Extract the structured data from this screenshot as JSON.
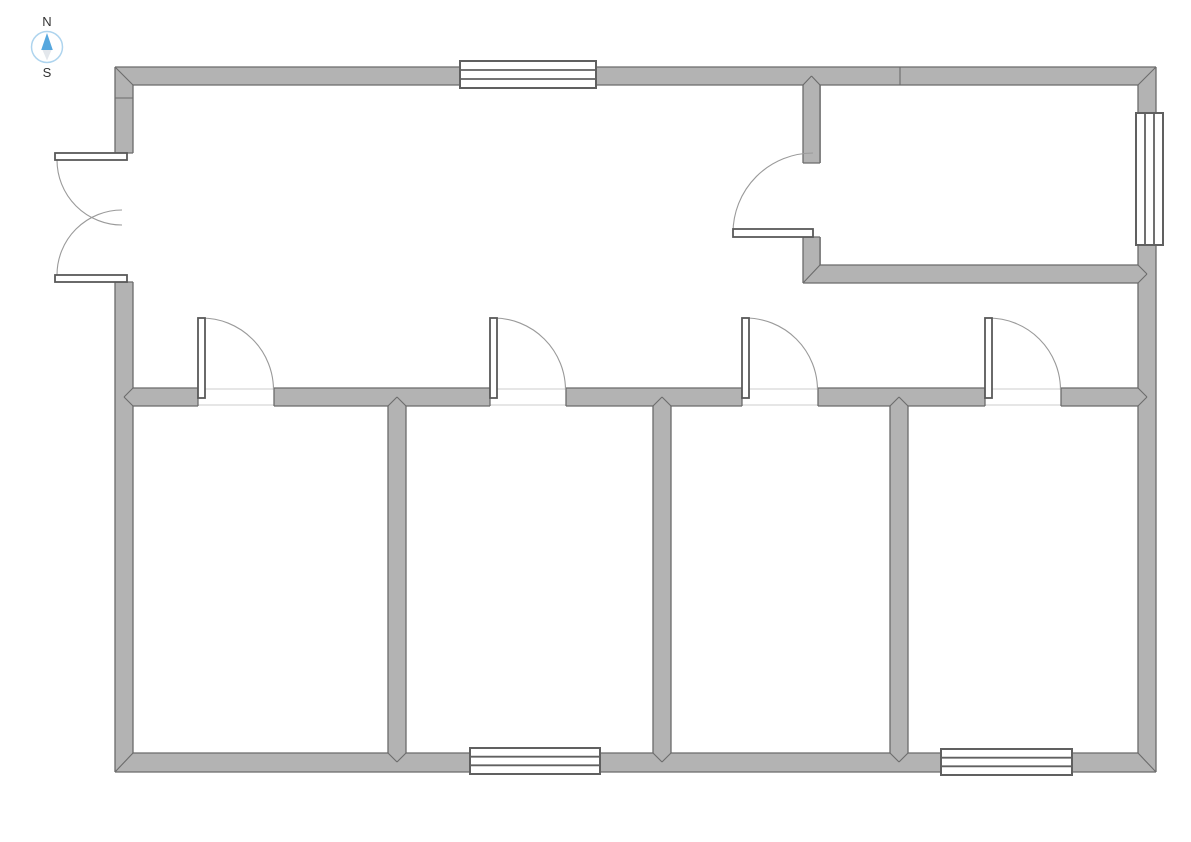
{
  "compass": {
    "north_label": "N",
    "south_label": "S",
    "ring_color": "#aed4ee",
    "north_needle_color": "#56a7de",
    "south_needle_color": "#e3e7ec",
    "label_color": "#333333"
  },
  "floor_plan": {
    "canvas": {
      "width": 1191,
      "height": 842,
      "background": "#ffffff"
    },
    "colors": {
      "wall_fill": "#b3b3b3",
      "wall_line": "#6b6b6b",
      "arc": "#9a9a9a",
      "leaf_stroke": "#595959",
      "window_border": "#606060",
      "threshold": "#d6d6d6"
    },
    "walls": [
      [
        115,
        67,
        345,
        18
      ],
      [
        596,
        67,
        560,
        18
      ],
      [
        115,
        67,
        18,
        86
      ],
      [
        115,
        282,
        18,
        490
      ],
      [
        1138,
        67,
        18,
        705
      ],
      [
        115,
        753,
        1041,
        19
      ],
      [
        133,
        388,
        65,
        18
      ],
      [
        274,
        388,
        216,
        18
      ],
      [
        566,
        388,
        176,
        18
      ],
      [
        818,
        388,
        167,
        18
      ],
      [
        1061,
        388,
        77,
        18
      ],
      [
        388,
        406,
        18,
        347
      ],
      [
        653,
        406,
        18,
        347
      ],
      [
        890,
        406,
        18,
        347
      ],
      [
        803,
        85,
        18,
        78
      ],
      [
        803,
        237,
        18,
        46
      ],
      [
        803,
        265,
        335,
        18
      ]
    ],
    "outline_lines": [
      [
        115,
        67,
        460,
        67
      ],
      [
        596,
        67,
        1156,
        67
      ],
      [
        115,
        67,
        115,
        153
      ],
      [
        115,
        282,
        115,
        772
      ],
      [
        1156,
        67,
        1156,
        772
      ],
      [
        115,
        772,
        470,
        772
      ],
      [
        600,
        772,
        941,
        772
      ],
      [
        1072,
        772,
        1156,
        772
      ],
      [
        133,
        85,
        460,
        85
      ],
      [
        596,
        85,
        803,
        85
      ],
      [
        820,
        85,
        1138,
        85
      ],
      [
        133,
        85,
        133,
        153
      ],
      [
        133,
        282,
        133,
        388
      ],
      [
        133,
        406,
        133,
        753
      ],
      [
        1138,
        85,
        1138,
        113
      ],
      [
        1138,
        245,
        1138,
        265
      ],
      [
        1138,
        283,
        1138,
        388
      ],
      [
        1138,
        406,
        1138,
        753
      ],
      [
        133,
        753,
        388,
        753
      ],
      [
        406,
        753,
        470,
        753
      ],
      [
        600,
        753,
        653,
        753
      ],
      [
        671,
        753,
        890,
        753
      ],
      [
        908,
        753,
        941,
        753
      ],
      [
        1072,
        753,
        1138,
        753
      ],
      [
        115,
        153,
        133,
        153
      ],
      [
        115,
        282,
        133,
        282
      ],
      [
        133,
        388,
        198,
        388
      ],
      [
        274,
        388,
        490,
        388
      ],
      [
        566,
        388,
        742,
        388
      ],
      [
        818,
        388,
        985,
        388
      ],
      [
        1061,
        388,
        1138,
        388
      ],
      [
        133,
        406,
        198,
        406
      ],
      [
        274,
        406,
        388,
        406
      ],
      [
        406,
        406,
        490,
        406
      ],
      [
        566,
        406,
        653,
        406
      ],
      [
        671,
        406,
        742,
        406
      ],
      [
        818,
        406,
        890,
        406
      ],
      [
        908,
        406,
        985,
        406
      ],
      [
        1061,
        406,
        1138,
        406
      ],
      [
        198,
        388,
        198,
        406
      ],
      [
        274,
        388,
        274,
        406
      ],
      [
        490,
        388,
        490,
        406
      ],
      [
        566,
        388,
        566,
        406
      ],
      [
        742,
        388,
        742,
        406
      ],
      [
        818,
        388,
        818,
        406
      ],
      [
        985,
        388,
        985,
        406
      ],
      [
        1061,
        388,
        1061,
        406
      ],
      [
        388,
        406,
        388,
        753
      ],
      [
        406,
        406,
        406,
        753
      ],
      [
        653,
        406,
        653,
        753
      ],
      [
        671,
        406,
        671,
        753
      ],
      [
        890,
        406,
        890,
        753
      ],
      [
        908,
        406,
        908,
        753
      ],
      [
        803,
        85,
        803,
        163
      ],
      [
        820,
        85,
        820,
        163
      ],
      [
        803,
        163,
        820,
        163
      ],
      [
        803,
        237,
        820,
        237
      ],
      [
        803,
        237,
        803,
        283
      ],
      [
        820,
        237,
        820,
        265
      ],
      [
        820,
        265,
        1138,
        265
      ],
      [
        803,
        283,
        1138,
        283
      ]
    ],
    "joint_lines": [
      [
        115,
        67,
        133,
        85
      ],
      [
        1156,
        67,
        1138,
        85
      ],
      [
        115,
        772,
        133,
        753
      ],
      [
        1156,
        772,
        1138,
        753
      ],
      [
        803,
        85,
        811.5,
        76
      ],
      [
        820,
        85,
        811.5,
        76
      ],
      [
        803,
        283,
        820,
        265
      ],
      [
        1138,
        265,
        1147,
        274
      ],
      [
        1138,
        283,
        1147,
        274
      ],
      [
        133,
        388,
        124,
        397
      ],
      [
        133,
        406,
        124,
        397
      ],
      [
        1138,
        388,
        1147,
        397
      ],
      [
        1138,
        406,
        1147,
        397
      ],
      [
        388,
        406,
        397,
        397
      ],
      [
        406,
        406,
        397,
        397
      ],
      [
        653,
        406,
        662,
        397
      ],
      [
        671,
        406,
        662,
        397
      ],
      [
        890,
        406,
        899,
        397
      ],
      [
        908,
        406,
        899,
        397
      ],
      [
        388,
        753,
        397,
        762
      ],
      [
        406,
        753,
        397,
        762
      ],
      [
        653,
        753,
        662,
        762
      ],
      [
        671,
        753,
        662,
        762
      ],
      [
        890,
        753,
        899,
        762
      ],
      [
        908,
        753,
        899,
        762
      ],
      [
        900,
        67,
        900,
        85
      ],
      [
        115,
        98,
        133,
        98
      ]
    ],
    "threshold_lines": [
      [
        198,
        389,
        274,
        389
      ],
      [
        490,
        389,
        566,
        389
      ],
      [
        742,
        389,
        818,
        389
      ],
      [
        985,
        389,
        1061,
        389
      ],
      [
        198,
        405,
        274,
        405
      ],
      [
        490,
        405,
        566,
        405
      ],
      [
        742,
        405,
        818,
        405
      ],
      [
        985,
        405,
        1061,
        405
      ]
    ],
    "windows": [
      {
        "x": 460,
        "y": 61,
        "w": 136,
        "h": 27,
        "dir": "h"
      },
      {
        "x": 470,
        "y": 748,
        "w": 130,
        "h": 26,
        "dir": "h"
      },
      {
        "x": 941,
        "y": 749,
        "w": 131,
        "h": 26,
        "dir": "h"
      },
      {
        "x": 1136,
        "y": 113,
        "w": 27,
        "h": 132,
        "dir": "v"
      }
    ],
    "door_leaves": [
      [
        198,
        318,
        7,
        80
      ],
      [
        490,
        318,
        7,
        80
      ],
      [
        742,
        318,
        7,
        80
      ],
      [
        985,
        318,
        7,
        80
      ],
      [
        55,
        153,
        72,
        7
      ],
      [
        55,
        275,
        72,
        7
      ],
      [
        733,
        229,
        80,
        8
      ]
    ],
    "door_arcs": [
      "M 201.5 318 A 72 72 0 0 1 273.5 390",
      "M 493.5 318 A 72 72 0 0 1 565.5 390",
      "M 745.5 318 A 72 72 0 0 1 817.5 390",
      "M 988.5 318 A 72 72 0 0 1 1060.5 390",
      "M 57 160 A 65 65 0 0 0 122 225",
      "M 57 275 A 65 65 0 0 1 122 210",
      "M 733 233 A 80 80 0 0 1 813 153"
    ]
  }
}
